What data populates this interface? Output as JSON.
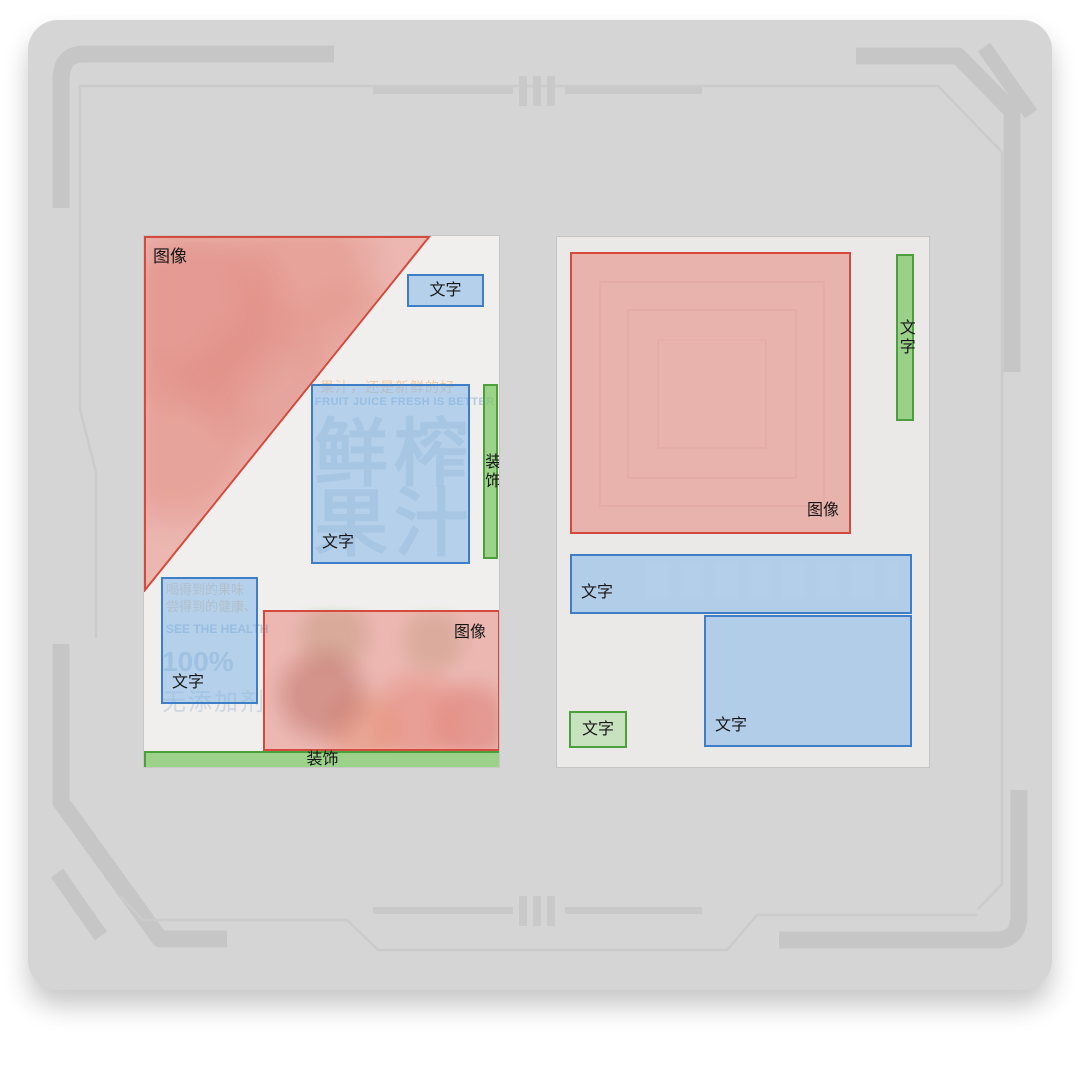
{
  "labels": {
    "image": "图像",
    "text": "文字",
    "decoration": "装饰"
  },
  "palette": {
    "image": {
      "fill": "rgba(228,106,92,0.42)",
      "border": "#d54a3c"
    },
    "text": {
      "fill": "rgba(132,182,232,0.55)",
      "border": "#3e7ec6"
    },
    "decoration": {
      "fill": "rgba(124,198,100,0.72)",
      "border": "#4ca03c"
    },
    "decoration_light": {
      "fill": "rgba(160,215,140,0.45)",
      "border": "#4ca03c"
    },
    "label_color": "#161616",
    "card_bg": "#d5d5d5",
    "decor_band": "#c6c6c6",
    "decor_line": "#cbcbcb"
  },
  "posters": [
    {
      "name": "poster-left",
      "x": 143,
      "y": 235,
      "w": 357,
      "h": 533,
      "bg": "#f0efed",
      "decor": [
        "art-tri-photo",
        "art-bottom-photo"
      ],
      "artwork_texts": [
        {
          "id": "slogan-cn",
          "text": "果汁，还是新鲜的好"
        },
        {
          "id": "slogan-en",
          "text": "FRUIT JUICE FRESH IS BETTER"
        },
        {
          "id": "big-chars",
          "text": "鲜榨果汁"
        },
        {
          "id": "side-line-1",
          "text": "喝得到的果味"
        },
        {
          "id": "side-line-2",
          "text": "尝得到的健康、"
        },
        {
          "id": "side-line-3",
          "text": "SEE THE HEALTH"
        },
        {
          "id": "side-100",
          "text": "100%"
        },
        {
          "id": "side-add",
          "text": "无添加剂"
        }
      ],
      "regions": [
        {
          "kind": "image",
          "shape": "triangle",
          "x": 0,
          "y": 0,
          "w": 290,
          "h": 356,
          "points": "1,1 285,1 1,354",
          "label": "图像",
          "label_pos": "top-left"
        },
        {
          "kind": "text",
          "x": 263,
          "y": 38,
          "w": 77,
          "h": 33,
          "label": "文字",
          "label_pos": "center"
        },
        {
          "kind": "text",
          "x": 167,
          "y": 148,
          "w": 159,
          "h": 180,
          "label": "文字",
          "label_pos": "bottom-left"
        },
        {
          "kind": "decoration",
          "x": 339,
          "y": 148,
          "w": 15,
          "h": 175,
          "label": "装饰",
          "label_pos": "center-vertical"
        },
        {
          "kind": "text",
          "x": 17,
          "y": 341,
          "w": 97,
          "h": 127,
          "label": "文字",
          "label_pos": "bottom-left"
        },
        {
          "kind": "image",
          "x": 119,
          "y": 374,
          "w": 237,
          "h": 141,
          "label": "图像",
          "label_pos": "top-right"
        },
        {
          "kind": "decoration",
          "x": 0,
          "y": 515,
          "w": 357,
          "h": 18,
          "label": "装饰",
          "label_pos": "center"
        }
      ]
    },
    {
      "name": "poster-right",
      "x": 556,
      "y": 236,
      "w": 374,
      "h": 532,
      "bg": "#eae9e7",
      "decor": [
        "art-nested-squares",
        "art-bar-ghost"
      ],
      "artwork_texts": [],
      "regions": [
        {
          "kind": "image",
          "x": 13,
          "y": 15,
          "w": 281,
          "h": 282,
          "label": "图像",
          "label_pos": "bottom-right"
        },
        {
          "kind": "decoration",
          "x": 339,
          "y": 17,
          "w": 18,
          "h": 167,
          "label": "文字",
          "label_pos": "center-vertical"
        },
        {
          "kind": "text",
          "x": 13,
          "y": 317,
          "w": 342,
          "h": 60,
          "label": "文字",
          "label_pos": "bottom-left"
        },
        {
          "kind": "text",
          "x": 147,
          "y": 378,
          "w": 208,
          "h": 132,
          "label": "文字",
          "label_pos": "bottom-left"
        },
        {
          "kind": "decoration",
          "light": true,
          "x": 12,
          "y": 474,
          "w": 58,
          "h": 37,
          "label": "文字",
          "label_pos": "center"
        }
      ]
    }
  ]
}
